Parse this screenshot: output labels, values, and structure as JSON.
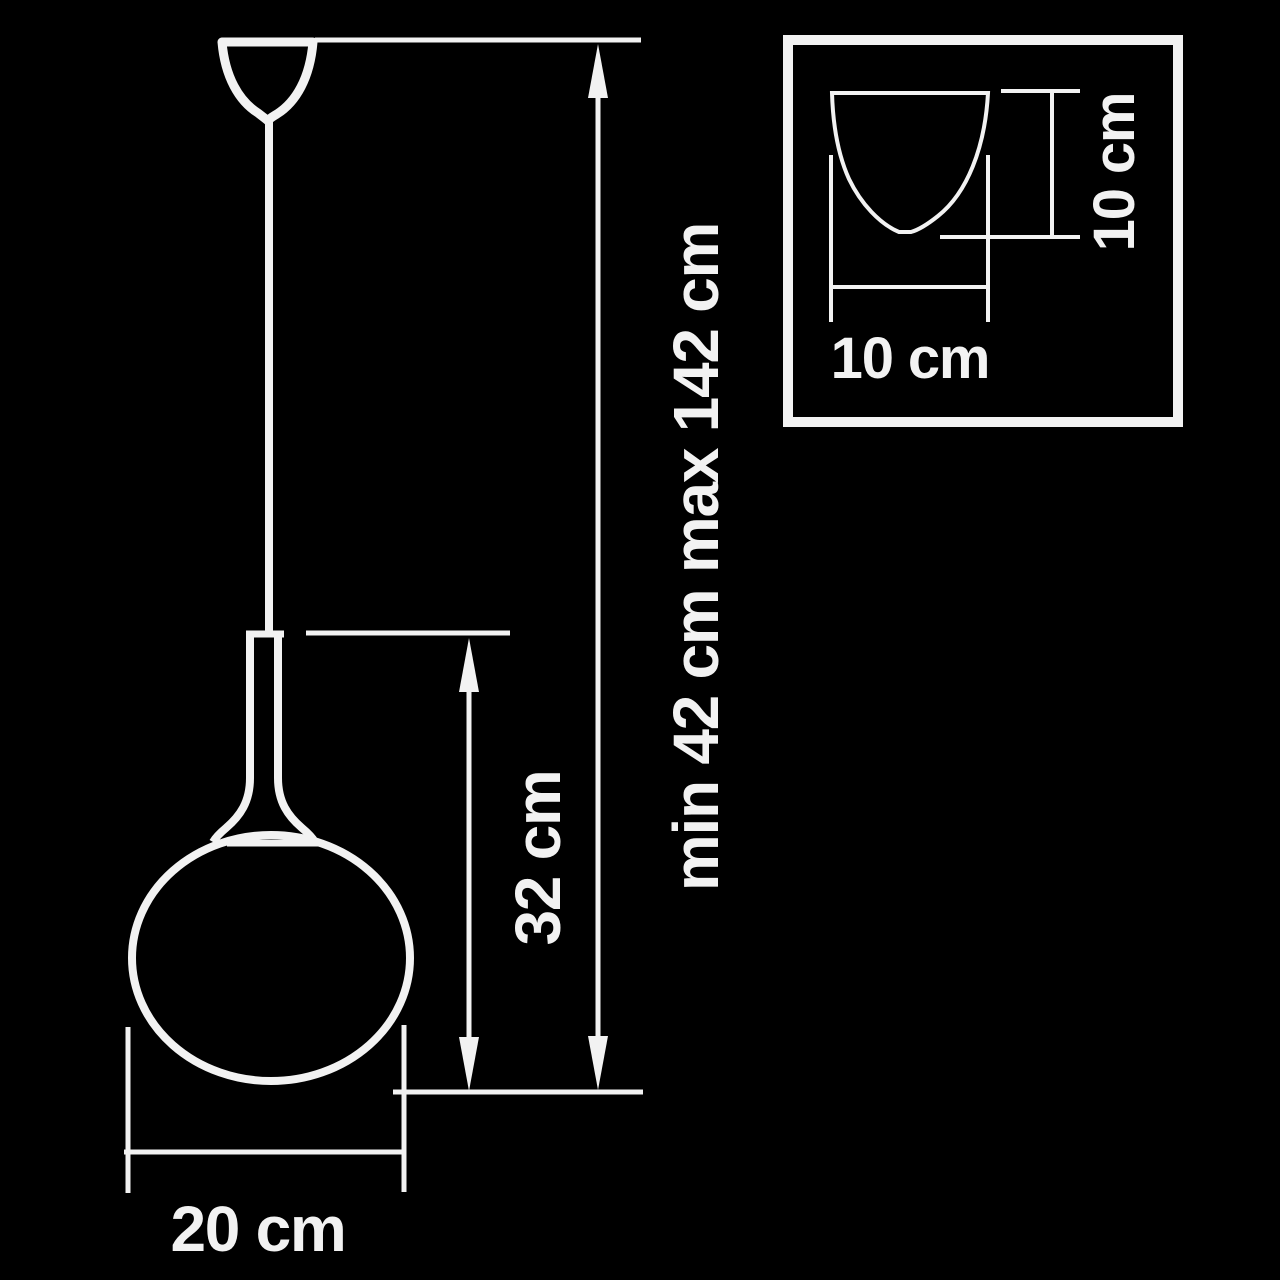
{
  "page": {
    "background_color": "#000000",
    "line_color": "#f2f2f2",
    "description": "Technical dimension drawing of a pendant lamp with spherical glass shade and ceiling canopy detail inset"
  },
  "diagram": {
    "labels": {
      "suspension_height": "min 42 cm max 142 cm",
      "body_height": "32 cm",
      "shade_diameter": "20 cm",
      "canopy_width": "10 cm",
      "canopy_height": "10 cm"
    }
  }
}
